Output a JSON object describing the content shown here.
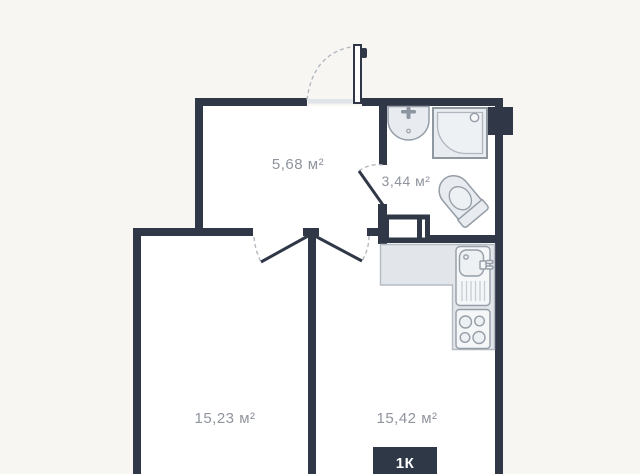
{
  "rooms": {
    "hallway": {
      "area": "5,68 м²"
    },
    "bathroom": {
      "area": "3,44 м²"
    },
    "bedroom": {
      "area": "15,23 м²"
    },
    "kitchen": {
      "area": "15,42 м²"
    }
  },
  "badge": {
    "label": "1К"
  },
  "icons": [
    "entrance-door-icon",
    "bedroom-door-icon",
    "kitchen-door-icon",
    "bathroom-door-icon",
    "wash-basin-icon",
    "shower-icon",
    "toilet-icon",
    "washing-machine-icon",
    "kitchen-counter-icon",
    "kitchen-sink-icon",
    "stove-icon"
  ],
  "colors": {
    "wall": "#303747",
    "room_background": "#ffffff",
    "outside_background": "#f7f6f3",
    "fixture_fill": "#e8ebef",
    "fixture_stroke": "#959da7",
    "counter_fill": "#e2e6ea",
    "door_arc": "#b4b9c0",
    "label_text": "#8f949d",
    "badge_background": "#2e3847",
    "badge_text": "#ffffff"
  }
}
